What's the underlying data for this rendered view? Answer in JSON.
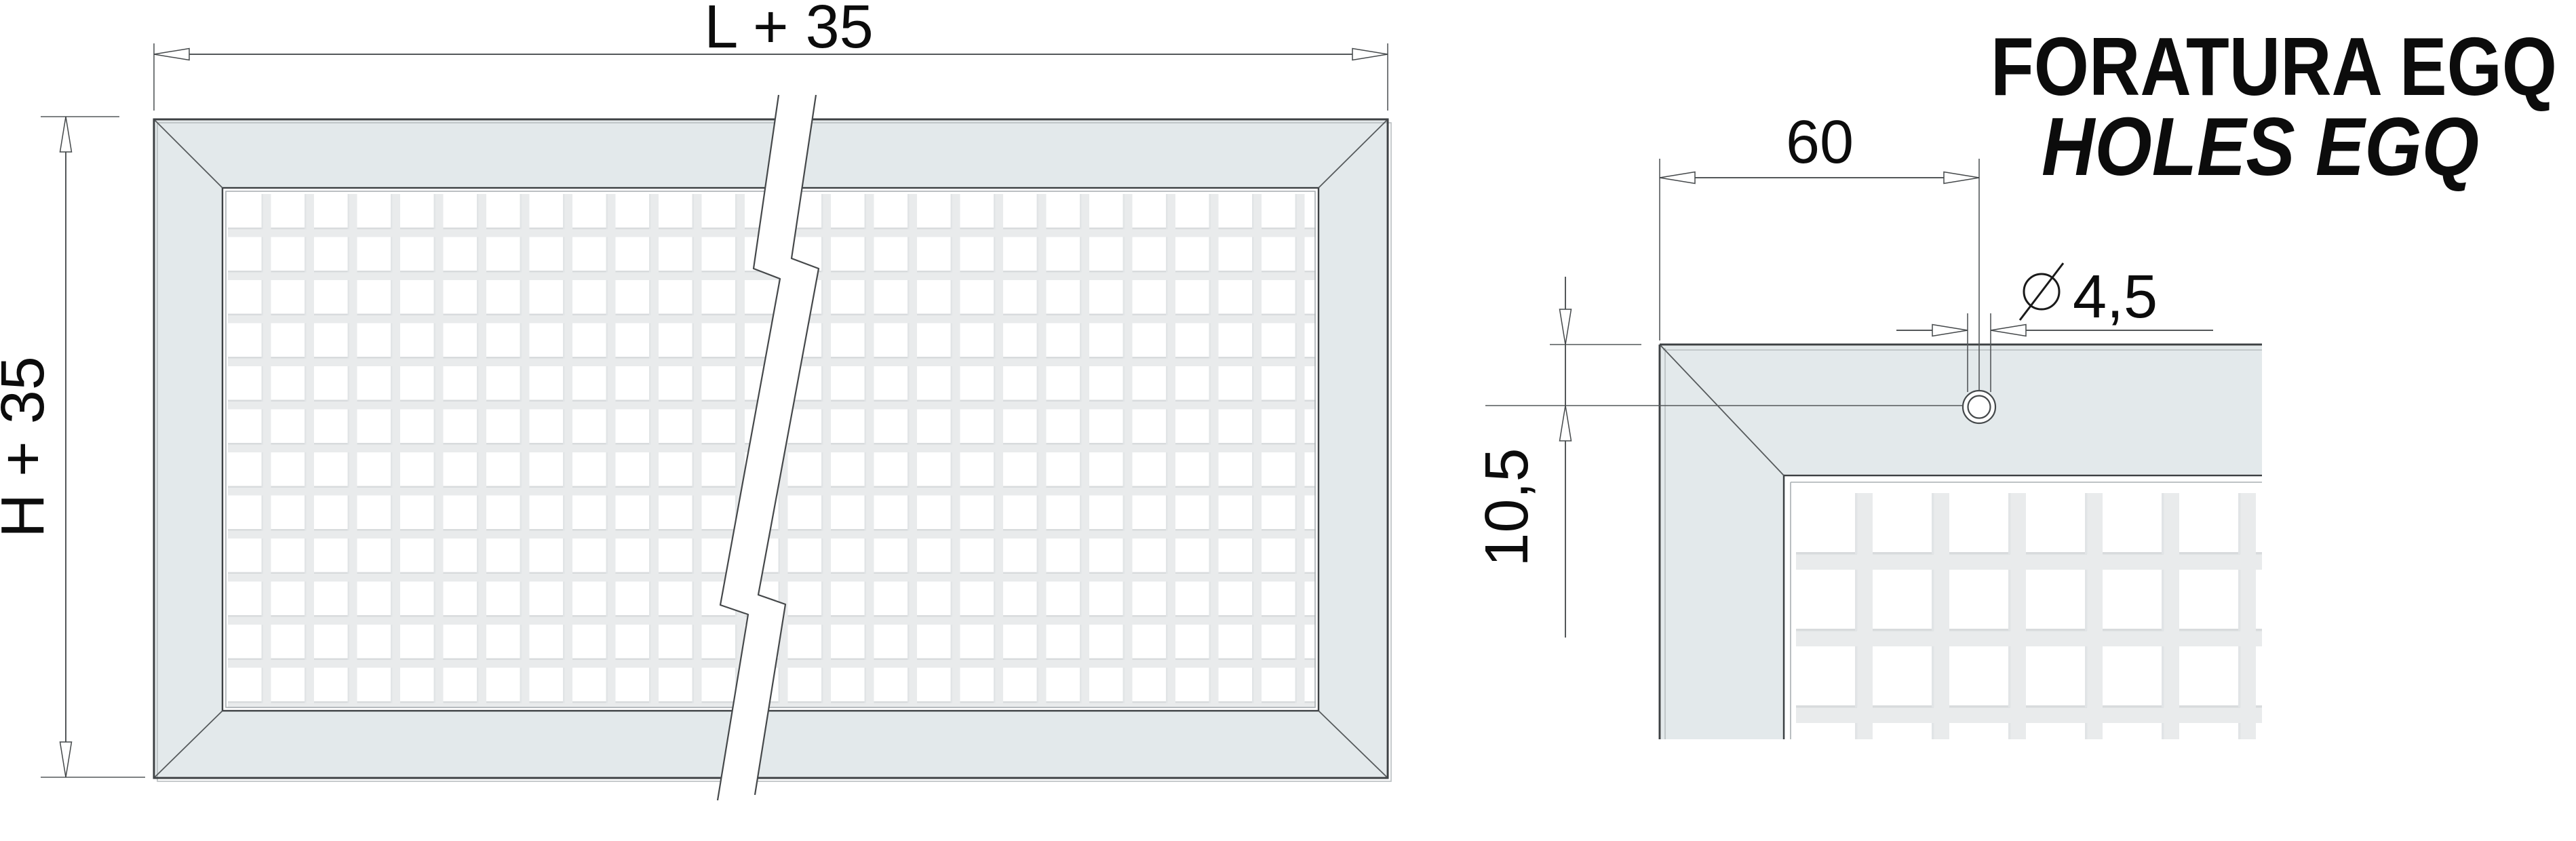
{
  "title": {
    "line1": "FORATURA EGQ",
    "line2": "HOLES EGQ"
  },
  "front_view": {
    "width_dim_label": "L + 35",
    "height_dim_label": "H + 35"
  },
  "detail_view": {
    "hole_offset_dim_label": "60",
    "hole_diameter_symbol": "⌀",
    "hole_diameter_dim_label": "4,5",
    "hole_edge_distance_dim_label": "10,5"
  },
  "colors": {
    "frame_fill": "#e3e9eb",
    "mesh_gap": "#e9ebec",
    "mesh_cell": "#ffffff",
    "outline_dark": "#3c4043",
    "dimension_line": "#54585a",
    "text": "#0c0c0c"
  }
}
